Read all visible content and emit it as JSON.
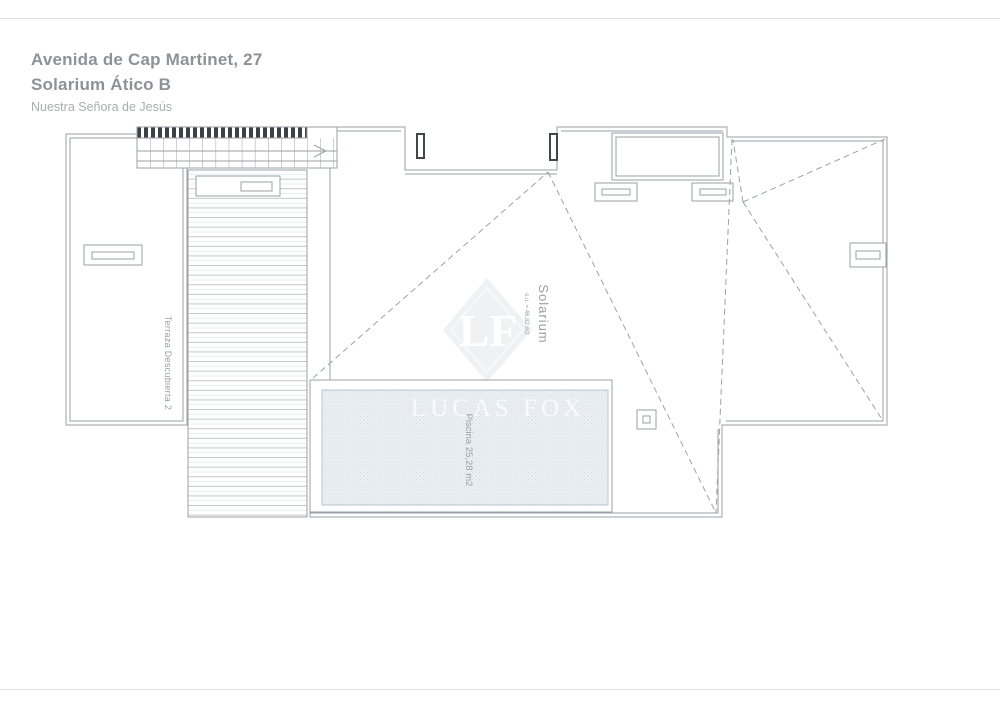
{
  "header": {
    "address": "Avenida de Cap Martinet, 27",
    "unit": "Solarium Ático B",
    "area_name": "Nuestra Señora de Jesús"
  },
  "plan": {
    "rooms": {
      "solarium": {
        "name": "Solarium",
        "area_note": "s.u. = 46,82 m2"
      },
      "pool": {
        "label": "Piscina 25,28 m2"
      },
      "terrace": {
        "label": "Terraza Descubierta 2"
      }
    },
    "colors": {
      "line": "#9ba2a7",
      "dark_fixture": "#3d4145",
      "pool_fill": "#eef2f6",
      "pool_hatch": "#ccd7df",
      "watermark": "#f0f1f3"
    }
  },
  "watermark": {
    "initials": "LF",
    "brand": "LUCAS FOX"
  }
}
